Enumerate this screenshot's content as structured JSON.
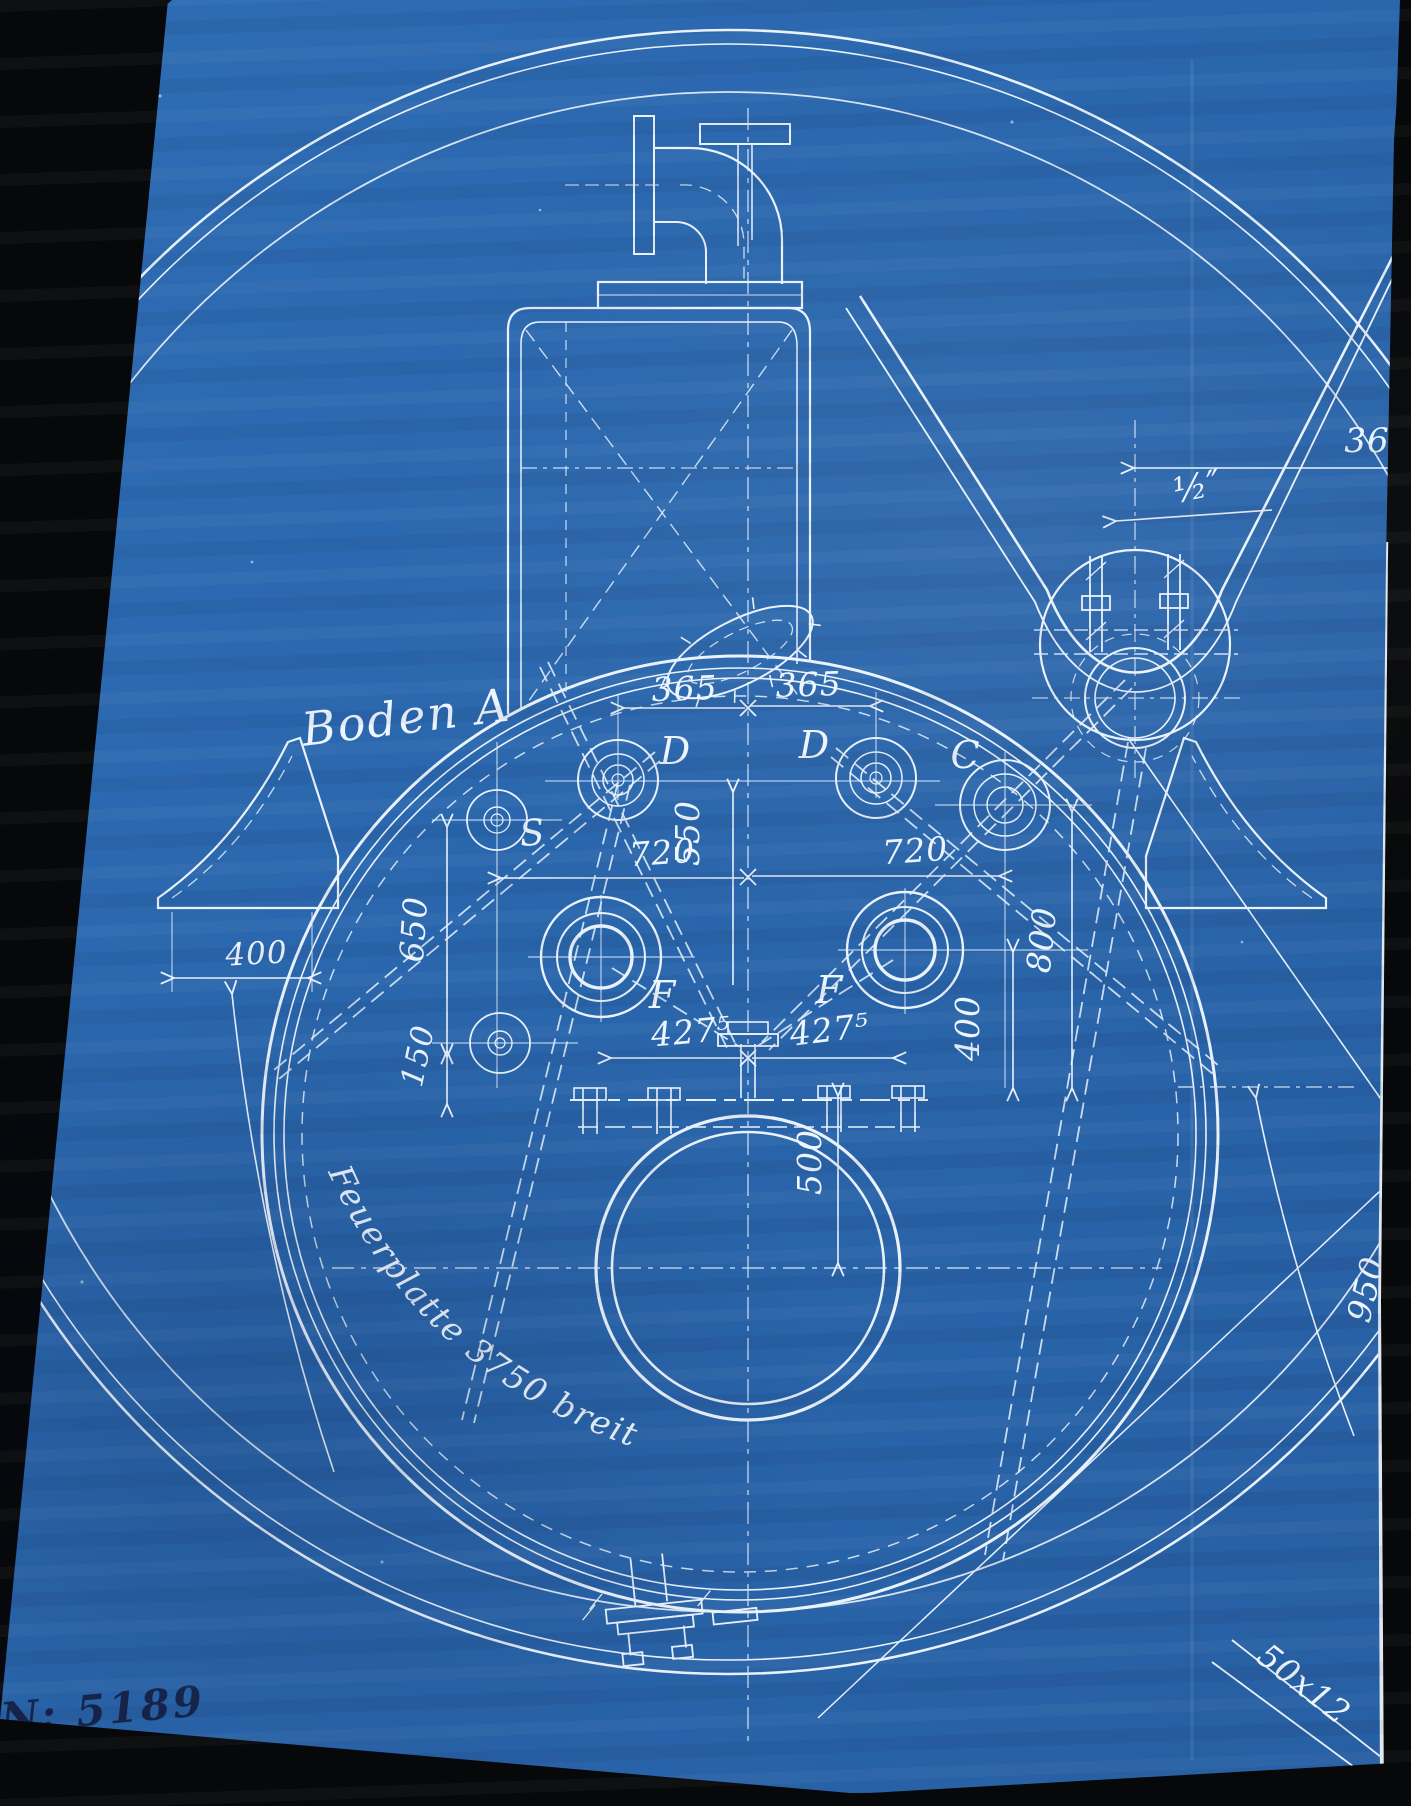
{
  "document": {
    "type": "scanned-blueprint",
    "view_title": "Boden A",
    "drawing_number": "N: 5189",
    "plate_note": "Feuerplatte 3750 breit",
    "colors": {
      "paper_blue": "#2b67ae",
      "line_white": "#e9f2fc",
      "ink_dark": "#18254b",
      "scan_edge_black": "#070809",
      "paper_backing": "#dfe7ef"
    }
  },
  "labels": [
    {
      "name": "label-boden-a",
      "text": "Boden A",
      "x": 408,
      "y": 733,
      "rot": -7,
      "size": 46,
      "cls": "script"
    },
    {
      "name": "label-d-left",
      "text": "D",
      "x": 676,
      "y": 764,
      "rot": 0,
      "size": 38,
      "cls": "script"
    },
    {
      "name": "label-d-right",
      "text": "D",
      "x": 815,
      "y": 758,
      "rot": 0,
      "size": 38,
      "cls": "script"
    },
    {
      "name": "label-c",
      "text": "C",
      "x": 966,
      "y": 768,
      "rot": 0,
      "size": 38,
      "cls": "script"
    },
    {
      "name": "label-s",
      "text": "S",
      "x": 534,
      "y": 845,
      "rot": -5,
      "size": 36,
      "cls": "script"
    },
    {
      "name": "label-f-left",
      "text": "F",
      "x": 663,
      "y": 1008,
      "rot": 0,
      "size": 38,
      "cls": "script"
    },
    {
      "name": "label-f-right",
      "text": "F",
      "x": 830,
      "y": 1003,
      "rot": 0,
      "size": 38,
      "cls": "script"
    },
    {
      "name": "dim-365-left",
      "text": "365",
      "x": 685,
      "y": 700,
      "rot": -2,
      "size": 33
    },
    {
      "name": "dim-365-right",
      "text": "365",
      "x": 809,
      "y": 696,
      "rot": -2,
      "size": 33
    },
    {
      "name": "dim-550",
      "text": "550",
      "x": 699,
      "y": 833,
      "rot": -90,
      "size": 33
    },
    {
      "name": "dim-720-left",
      "text": "720",
      "x": 663,
      "y": 864,
      "rot": -4,
      "size": 33
    },
    {
      "name": "dim-720-right",
      "text": "720",
      "x": 916,
      "y": 862,
      "rot": -4,
      "size": 33
    },
    {
      "name": "dim-650",
      "text": "650",
      "x": 425,
      "y": 930,
      "rot": -86,
      "size": 33
    },
    {
      "name": "dim-150",
      "text": "150",
      "x": 428,
      "y": 1058,
      "rot": -78,
      "size": 31
    },
    {
      "name": "dim-400-left",
      "text": "400",
      "x": 257,
      "y": 964,
      "rot": -3,
      "size": 31
    },
    {
      "name": "dim-427-left",
      "text": "427⁵",
      "x": 692,
      "y": 1043,
      "rot": -5,
      "size": 33
    },
    {
      "name": "dim-427-right",
      "text": "427⁵",
      "x": 831,
      "y": 1041,
      "rot": -7,
      "size": 33
    },
    {
      "name": "dim-400-right",
      "text": "400",
      "x": 979,
      "y": 1028,
      "rot": -90,
      "size": 33
    },
    {
      "name": "dim-800",
      "text": "800",
      "x": 1053,
      "y": 941,
      "rot": -84,
      "size": 33
    },
    {
      "name": "dim-500",
      "text": "500",
      "x": 821,
      "y": 1162,
      "rot": -90,
      "size": 33
    },
    {
      "name": "dim-950",
      "text": "950",
      "x": 1377,
      "y": 1292,
      "rot": -76,
      "size": 33
    },
    {
      "name": "dim-36",
      "text": "36",
      "x": 1367,
      "y": 452,
      "rot": 0,
      "size": 34
    },
    {
      "name": "dim-half-inch",
      "text": "½″",
      "x": 1200,
      "y": 498,
      "rot": -12,
      "size": 35
    },
    {
      "name": "dim-50x12",
      "text": "50x12",
      "x": 1297,
      "y": 1693,
      "rot": 38,
      "size": 33
    },
    {
      "name": "label-feuerplatte",
      "text": "Feuerplatte 3750 breit",
      "curve": "M328,1172 Q424,1388 668,1458",
      "size": 33,
      "cls": "script"
    },
    {
      "name": "drawing-number",
      "text": "N: 5189",
      "x": 104,
      "y": 1724,
      "rot": -5,
      "size": 42,
      "cls": "ink"
    }
  ]
}
